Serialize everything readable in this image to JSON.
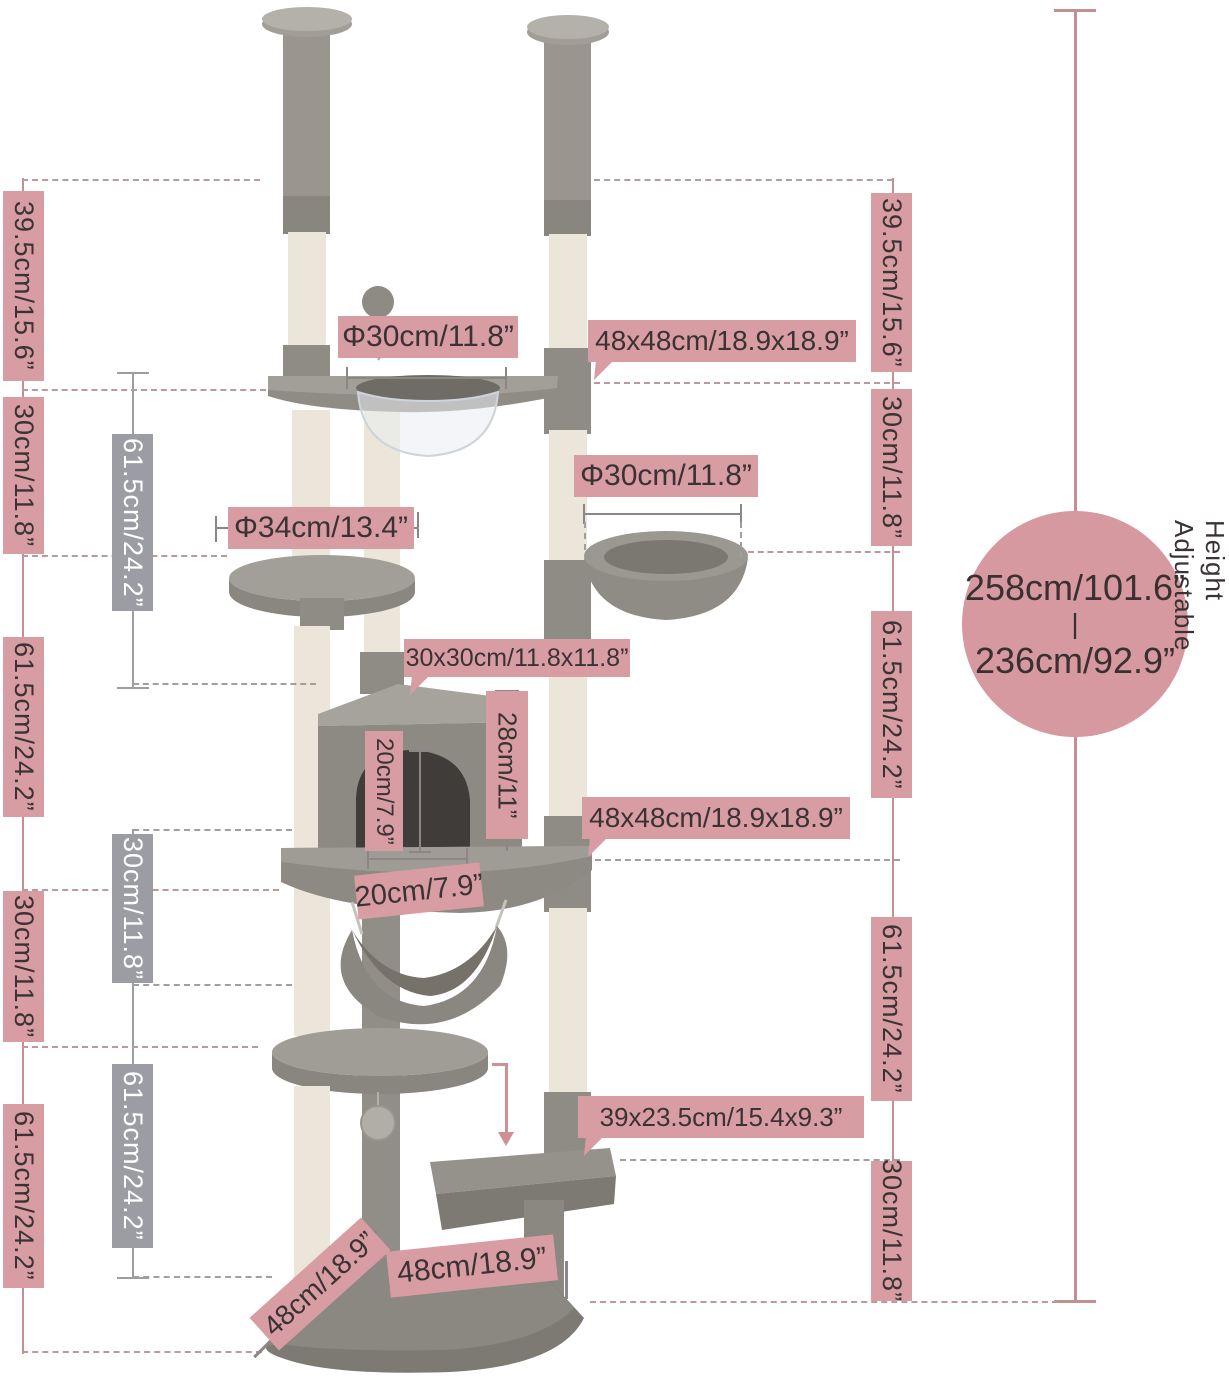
{
  "title": "Height-adjustable cat tree dimension diagram",
  "colors": {
    "callout_pink": "#d89da2",
    "callout_gray": "#9c9ca4",
    "circle_pink": "#d5999f",
    "line_pink": "#c48f94",
    "text_dark": "#3a3234",
    "plush_gray": "#8f8b85",
    "sisal_cream": "#ebe6d9"
  },
  "summary_circle": {
    "max_height": "258cm/101.6”",
    "divider": "|",
    "min_height": "236cm/92.9”",
    "side_note": "Height Adjustable"
  },
  "left_outer_labels": [
    "39.5cm/15.6”",
    "30cm/11.8”",
    "61.5cm/24.2”",
    "30cm/11.8”",
    "61.5cm/24.2”"
  ],
  "left_inner_labels": [
    "61.5cm/24.2”",
    "30cm/11.8”",
    "61.5cm/24.2”"
  ],
  "right_labels": [
    "39.5cm/15.6”",
    "30cm/11.8”",
    "61.5cm/24.2”",
    "61.5cm/24.2”",
    "30cm/11.8”"
  ],
  "callouts": {
    "top_perch_diameter": "Φ30cm/11.8”",
    "top_platform_size": "48x48cm/18.9x18.9”",
    "basket_diameter": "Φ30cm/11.8”",
    "round_perch_diameter": "Φ34cm/13.4”",
    "condo_footprint": "30x30cm/11.8x11.8”",
    "condo_height": "28cm/11”",
    "door_height": "20cm/7.9”",
    "main_platform_size": "48x48cm/18.9x18.9”",
    "door_width": "20cm/7.9”",
    "step_size": "39x23.5cm/15.4x9.3”",
    "base_front": "48cm/18.9”",
    "base_side": "48cm/18.9”"
  }
}
